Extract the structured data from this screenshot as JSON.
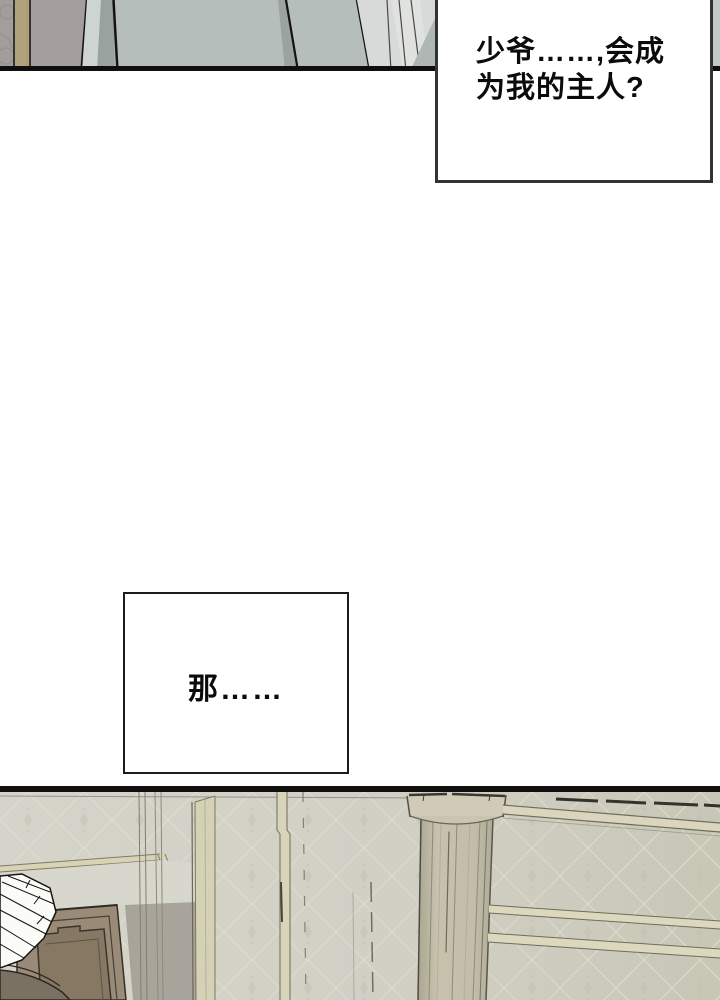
{
  "page": {
    "width": 720,
    "height": 1000,
    "background": "#ffffff"
  },
  "bubbles": [
    {
      "id": "bubble-1",
      "lines": [
        "少爷……,会成",
        "为我的主人?"
      ],
      "full_text": "少爷……,会成为我的主人?"
    },
    {
      "id": "bubble-2",
      "lines": [
        "那……"
      ],
      "full_text": "那……"
    }
  ],
  "palette": {
    "page_background": "#ffffff",
    "panel_border": "#11100e",
    "bubble1_border": "#333333",
    "bubble2_border": "#1c1c1c",
    "bubble_background": "#ffffff",
    "text_color": "#0b0b0b",
    "top_panel": {
      "wall_gray": "#a39d9d",
      "tan_stripe": "#b1a37e",
      "fabric_main": "#b5beba",
      "fabric_light": "#d7dad8",
      "fabric_shadow": "#99a29e",
      "right_sliver": "#c3cac6",
      "outline": "#14130f"
    },
    "bottom_panel": {
      "wall_left": "#d5d4ca",
      "wall_right": "#c8c7b6",
      "wallpaper_line": "#e0decf",
      "trim_beige": "#d8d3ba",
      "column_shaft": "#c2bda8",
      "column_capital": "#d0cbb6",
      "door_brown": "#9a8b79",
      "door_panel": "#867862",
      "doorway_shadow": "#a9a49b",
      "furniture_dark": "#7b7163",
      "lampshade": "#fbfbf8"
    }
  }
}
